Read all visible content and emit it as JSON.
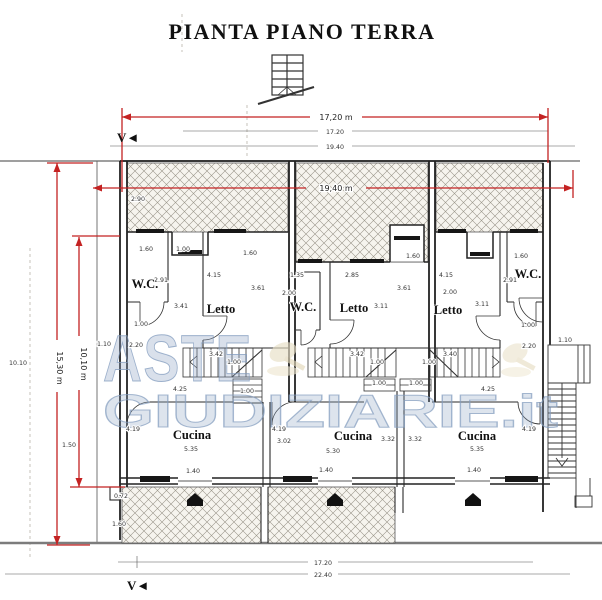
{
  "title": "PIANTA PIANO TERRA",
  "watermark": {
    "line1": "ASTE",
    "line2": "GIUDIZIARIE.it",
    "color": "#8fa5c4",
    "gavel_color": "#e8dfc6"
  },
  "view_markers": {
    "top": "V◄",
    "bottom": "V◄"
  },
  "colors": {
    "dimension_red": "#c42222",
    "wall": "#222222",
    "hatch_line": "#9a958a",
    "context_gray": "#777777"
  },
  "rooms": [
    {
      "t": "W.C.",
      "x": 145,
      "y": 288
    },
    {
      "t": "Letto",
      "x": 221,
      "y": 313
    },
    {
      "t": "W.C.",
      "x": 303,
      "y": 311
    },
    {
      "t": "Letto",
      "x": 354,
      "y": 312
    },
    {
      "t": "Letto",
      "x": 448,
      "y": 314
    },
    {
      "t": "W.C.",
      "x": 528,
      "y": 278
    },
    {
      "t": "Cucina",
      "x": 192,
      "y": 439
    },
    {
      "t": "Cucina",
      "x": 353,
      "y": 440
    },
    {
      "t": "Cucina",
      "x": 477,
      "y": 440
    }
  ],
  "red_dimensions": [
    {
      "t": "17,20 m",
      "x": 336,
      "y": 120
    },
    {
      "t": "19,40 m",
      "x": 336,
      "y": 191
    },
    {
      "t": "15,30 m",
      "x": 57,
      "y": 368,
      "r": 90
    },
    {
      "t": "10,10 m",
      "x": 81,
      "y": 364,
      "r": 90
    }
  ],
  "dim_labels": [
    {
      "t": "17.20",
      "x": 335,
      "y": 134
    },
    {
      "t": "19.40",
      "x": 335,
      "y": 149
    },
    {
      "t": "2.90",
      "x": 138,
      "y": 201
    },
    {
      "t": "10.10",
      "x": 18,
      "y": 365
    },
    {
      "t": "1.60",
      "x": 146,
      "y": 251
    },
    {
      "t": "1.00",
      "x": 183,
      "y": 251
    },
    {
      "t": "1.60",
      "x": 250,
      "y": 255
    },
    {
      "t": "4.15",
      "x": 214,
      "y": 277
    },
    {
      "t": "2.91",
      "x": 161,
      "y": 282
    },
    {
      "t": "3.61",
      "x": 258,
      "y": 290
    },
    {
      "t": "3.41",
      "x": 181,
      "y": 308
    },
    {
      "t": "1.00",
      "x": 141,
      "y": 326
    },
    {
      "t": "2.20",
      "x": 136,
      "y": 347
    },
    {
      "t": "1.10",
      "x": 104,
      "y": 346
    },
    {
      "t": "3.42",
      "x": 216,
      "y": 356
    },
    {
      "t": "1.00",
      "x": 234,
      "y": 364
    },
    {
      "t": "4.25",
      "x": 180,
      "y": 391
    },
    {
      "t": "1.00",
      "x": 247,
      "y": 393
    },
    {
      "t": "4.19",
      "x": 133,
      "y": 431
    },
    {
      "t": "3.02",
      "x": 284,
      "y": 443
    },
    {
      "t": "5.35",
      "x": 191,
      "y": 451
    },
    {
      "t": "1.40",
      "x": 193,
      "y": 473
    },
    {
      "t": "0.72",
      "x": 121,
      "y": 498
    },
    {
      "t": "1.60",
      "x": 119,
      "y": 526
    },
    {
      "t": "1.50",
      "x": 69,
      "y": 447
    },
    {
      "t": "1.35",
      "x": 297,
      "y": 277
    },
    {
      "t": "2.85",
      "x": 352,
      "y": 277
    },
    {
      "t": "2.00",
      "x": 289,
      "y": 295
    },
    {
      "t": "1.60",
      "x": 413,
      "y": 258
    },
    {
      "t": "3.11",
      "x": 381,
      "y": 308
    },
    {
      "t": "3.42",
      "x": 357,
      "y": 356
    },
    {
      "t": "1.00",
      "x": 377,
      "y": 364
    },
    {
      "t": "1.00",
      "x": 379,
      "y": 385
    },
    {
      "t": "1.00",
      "x": 416,
      "y": 385
    },
    {
      "t": "4.19",
      "x": 279,
      "y": 431
    },
    {
      "t": "3.32",
      "x": 388,
      "y": 441
    },
    {
      "t": "5.30",
      "x": 333,
      "y": 453
    },
    {
      "t": "1.40",
      "x": 326,
      "y": 472
    },
    {
      "t": "1.60",
      "x": 521,
      "y": 258
    },
    {
      "t": "4.15",
      "x": 446,
      "y": 277
    },
    {
      "t": "2.00",
      "x": 450,
      "y": 294
    },
    {
      "t": "2.91",
      "x": 510,
      "y": 282
    },
    {
      "t": "3.61",
      "x": 404,
      "y": 290
    },
    {
      "t": "3.11",
      "x": 482,
      "y": 306
    },
    {
      "t": "1.00",
      "x": 528,
      "y": 327
    },
    {
      "t": "2.20",
      "x": 529,
      "y": 348
    },
    {
      "t": "1.10",
      "x": 565,
      "y": 342
    },
    {
      "t": "3.40",
      "x": 450,
      "y": 356
    },
    {
      "t": "1.00",
      "x": 429,
      "y": 364
    },
    {
      "t": "4.25",
      "x": 488,
      "y": 391
    },
    {
      "t": "3.32",
      "x": 415,
      "y": 441
    },
    {
      "t": "4.19",
      "x": 529,
      "y": 431
    },
    {
      "t": "5.35",
      "x": 477,
      "y": 451
    },
    {
      "t": "1.40",
      "x": 474,
      "y": 472
    },
    {
      "t": "17.20",
      "x": 323,
      "y": 565
    },
    {
      "t": "22.40",
      "x": 323,
      "y": 577
    }
  ]
}
